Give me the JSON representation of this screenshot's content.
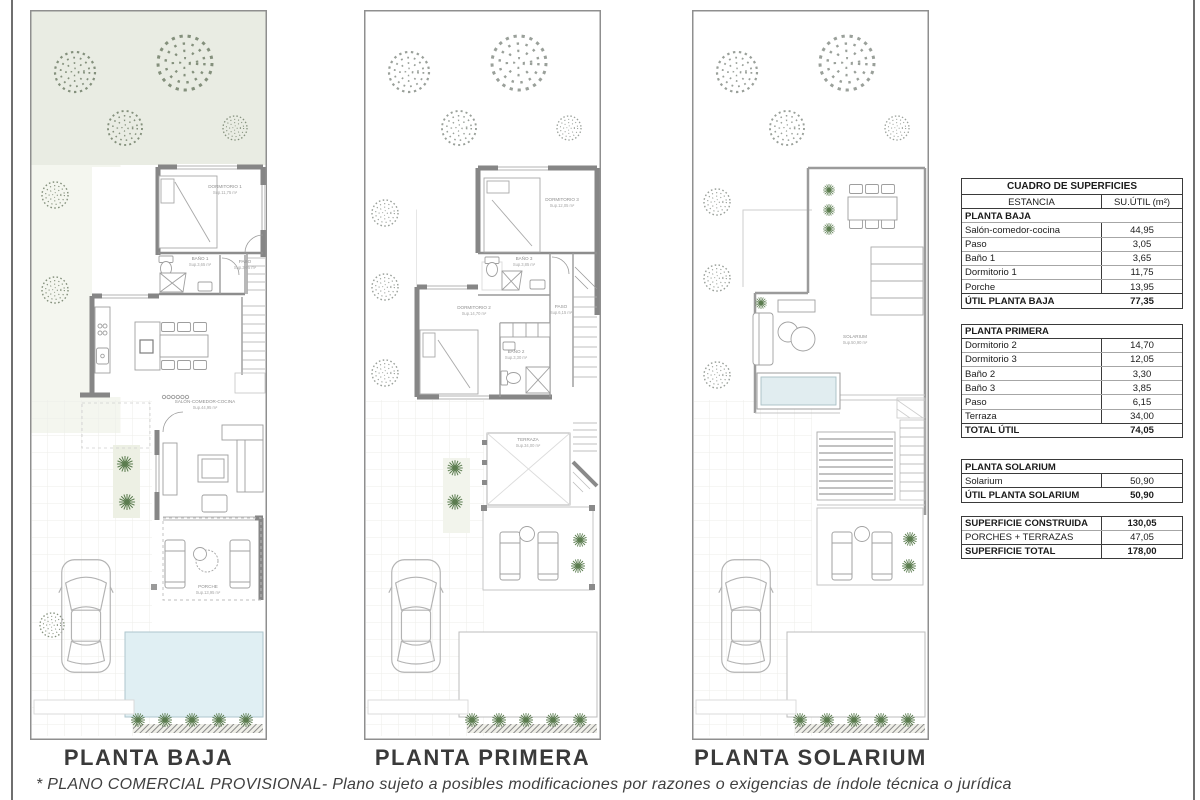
{
  "page": {
    "footer_note": "* PLANO COMERCIAL PROVISIONAL-  Plano sujeto a posibles modificaciones por razones o exigencias de índole técnica o jurídica"
  },
  "colors": {
    "wall_gray": "#868686",
    "garden_green": "#e9ece3",
    "pool_blue": "#e0eff3",
    "jacuzzi_blue": "#e1edf0",
    "plant_green": "#5b7c4f"
  },
  "plans": [
    {
      "title": "PLANTA BAJA",
      "labels": {
        "dormitorio1": {
          "name": "DORMITORIO 1",
          "area": "Sup.11,75 m²"
        },
        "bano1": {
          "name": "BAÑO 1",
          "area": "Sup.3,65 m²"
        },
        "paso": {
          "name": "PASO",
          "area": "Sup.3,05 m²"
        },
        "salon": {
          "name": "SALÓN-COMEDOR-COCINA",
          "area": "Sup.44,95 m²"
        },
        "porche": {
          "name": "PORCHE",
          "area": "Sup.13,95 m²"
        }
      }
    },
    {
      "title": "PLANTA PRIMERA",
      "labels": {
        "dormitorio3": {
          "name": "DORMITORIO 3",
          "area": "Sup.12,05 m²"
        },
        "bano3": {
          "name": "BAÑO 3",
          "area": "Sup.3,85 m²"
        },
        "dormitorio2": {
          "name": "DORMITORIO 2",
          "area": "Sup.14,70 m²"
        },
        "paso": {
          "name": "PASO",
          "area": "Sup.6,15 m²"
        },
        "bano2": {
          "name": "BAÑO 2",
          "area": "Sup.3,30 m²"
        },
        "terraza": {
          "name": "TERRAZA",
          "area": "Sup.34,00 m²"
        }
      }
    },
    {
      "title": "PLANTA SOLARIUM",
      "labels": {
        "solarium": {
          "name": "SOLARIUM",
          "area": "Sup.50,90 m²"
        }
      }
    }
  ],
  "table": {
    "title": "CUADRO DE SUPERFICIES",
    "columns": {
      "estancia": "ESTANCIA",
      "surface": "SU.ÚTIL (m²)"
    },
    "planta_baja": {
      "header": "PLANTA BAJA",
      "rows": [
        [
          "Salón-comedor-cocina",
          "44,95"
        ],
        [
          "Paso",
          "3,05"
        ],
        [
          "Baño 1",
          "3,65"
        ],
        [
          "Dormitorio 1",
          "11,75"
        ],
        [
          "Porche",
          "13,95"
        ]
      ],
      "total": [
        "ÚTIL PLANTA BAJA",
        "77,35"
      ]
    },
    "planta_primera": {
      "header": "PLANTA PRIMERA",
      "rows": [
        [
          "Dormitorio 2",
          "14,70"
        ],
        [
          "Dormitorio 3",
          "12,05"
        ],
        [
          "Baño 2",
          "3,30"
        ],
        [
          "Baño 3",
          "3,85"
        ],
        [
          "Paso",
          "6,15"
        ],
        [
          "Terraza",
          "34,00"
        ]
      ],
      "total": [
        "TOTAL ÚTIL",
        "74,05"
      ]
    },
    "planta_solarium": {
      "header": "PLANTA SOLARIUM",
      "rows": [
        [
          "Solarium",
          "50,90"
        ]
      ],
      "total": [
        "ÚTIL PLANTA SOLARIUM",
        "50,90"
      ]
    },
    "summary": {
      "rows": [
        [
          "SUPERFICIE CONSTRUIDA",
          "130,05"
        ],
        [
          "PORCHES + TERRAZAS",
          "47,05"
        ],
        [
          "SUPERFICIE TOTAL",
          "178,00"
        ]
      ]
    }
  }
}
